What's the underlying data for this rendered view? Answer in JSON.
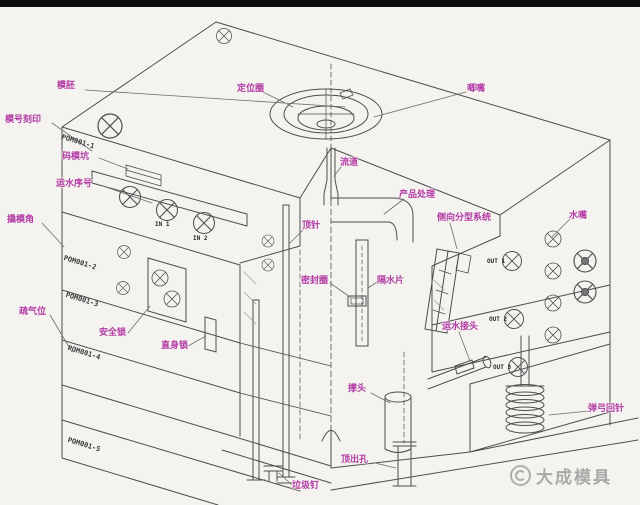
{
  "colors": {
    "label_magenta": "#b23aa4",
    "line_gray": "#4d4d4d",
    "background": "#f5f3f0",
    "top_bar": "#0d0d0d",
    "watermark_gray": "#8d8d8d"
  },
  "watermark": {
    "brand": "大成模具"
  },
  "plate_codes": [
    "POM001-1",
    "POM001-2",
    "POM001-3",
    "POM001-4",
    "POM001-5"
  ],
  "ports": {
    "in1": "IN 1",
    "in2": "IN 2",
    "out1": "OUT 1",
    "out2": "OUT 2",
    "out3": "OUT 3"
  },
  "callouts": {
    "mold_base": "模胚",
    "mold_number_engraving": "模号刻印",
    "clamping_slot": "码模坑",
    "water_line_number": "运水序号",
    "pry_slot": "撬模角",
    "air_vent": "疏气位",
    "safety_lock": "安全锁",
    "straight_interlock": "直身锁",
    "locating_ring": "定位圈",
    "sprue_bushing": "唧嘴",
    "runner": "流道",
    "product_area": "产品处理",
    "side_parting_system": "侧向分型系统",
    "water_nozzle": "水嘴",
    "ejector_pin": "顶针",
    "seal_ring": "密封圈",
    "water_baffle": "隔水片",
    "water_connector": "运水接头",
    "spring_return_pin": "弹弓回针",
    "support_pillar": "撑头",
    "ejection_hole": "顶出孔",
    "stop_pin": "垃圾钉"
  }
}
